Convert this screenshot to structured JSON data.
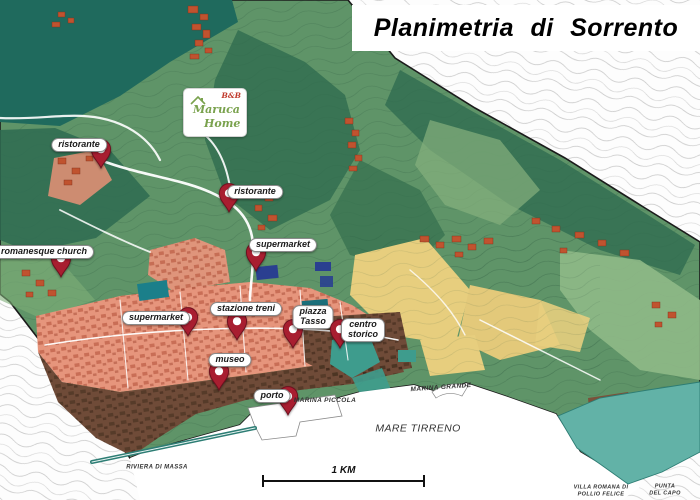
{
  "title": "Planimetria  di  Sorrento",
  "logo": {
    "bnb": "B&B",
    "name_line1": "Maruca",
    "name_line2": "Home"
  },
  "map": {
    "pins": [
      {
        "id": "ristorante-1",
        "label": "ristorante",
        "tip": {
          "x": 101,
          "y": 169
        },
        "label_pos": {
          "x": 79,
          "y": 145
        }
      },
      {
        "id": "ristorante-2",
        "label": "ristorante",
        "tip": {
          "x": 229,
          "y": 213
        },
        "label_pos": {
          "x": 255,
          "y": 192
        }
      },
      {
        "id": "supermarket-1",
        "label": "supermarket",
        "tip": {
          "x": 256,
          "y": 272
        },
        "label_pos": {
          "x": 283,
          "y": 245
        }
      },
      {
        "id": "romanesque-church",
        "label": "romanesque church",
        "tip": {
          "x": 61,
          "y": 278
        },
        "label_pos": {
          "x": 44,
          "y": 252
        }
      },
      {
        "id": "supermarket-2",
        "label": "supermarket",
        "tip": {
          "x": 188,
          "y": 337
        },
        "label_pos": {
          "x": 156,
          "y": 318
        }
      },
      {
        "id": "stazione-treni",
        "label": "stazione treni",
        "tip": {
          "x": 237,
          "y": 341
        },
        "label_pos": {
          "x": 246,
          "y": 309
        }
      },
      {
        "id": "piazza-tasso",
        "label": "piazza\nTasso",
        "tip": {
          "x": 293,
          "y": 349
        },
        "label_pos": {
          "x": 313,
          "y": 317
        }
      },
      {
        "id": "centro-storico",
        "label": "centro\nstorico",
        "tip": {
          "x": 340,
          "y": 349
        },
        "label_pos": {
          "x": 363,
          "y": 330
        }
      },
      {
        "id": "museo",
        "label": "museo",
        "tip": {
          "x": 219,
          "y": 391
        },
        "label_pos": {
          "x": 230,
          "y": 360
        }
      },
      {
        "id": "porto",
        "label": "porto",
        "tip": {
          "x": 288,
          "y": 416
        },
        "label_pos": {
          "x": 272,
          "y": 396
        }
      }
    ],
    "place_labels": [
      {
        "id": "marina-piccola",
        "lines": [
          "MARINA PICCOLA"
        ],
        "x": 325,
        "y": 401,
        "size": 6.5,
        "weight": 700,
        "rotate": 0
      },
      {
        "id": "marina-grande",
        "lines": [
          "MARINA GRANDE"
        ],
        "x": 441,
        "y": 388,
        "size": 6.5,
        "weight": 700,
        "rotate": -4
      },
      {
        "id": "mare-tirreno",
        "lines": [
          "MARE TIRRENO"
        ],
        "x": 418,
        "y": 429,
        "size": 10.5,
        "weight": 400,
        "rotate": 0
      },
      {
        "id": "riviera-di-massa",
        "lines": [
          "RIVIERA DI MASSA"
        ],
        "x": 157,
        "y": 468,
        "size": 6,
        "weight": 700,
        "rotate": 0
      },
      {
        "id": "villa-romana-di-pollio-felice",
        "lines": [
          "VILLA ROMANA DI",
          "POLLIO FELICE"
        ],
        "x": 601,
        "y": 491,
        "size": 5.5,
        "weight": 700,
        "rotate": 0
      },
      {
        "id": "punta-del-capo",
        "lines": [
          "PUNTA",
          "DEL CAPO"
        ],
        "x": 665,
        "y": 490,
        "size": 5.5,
        "weight": 700,
        "rotate": 0
      }
    ],
    "scale": {
      "label": "1 KM"
    }
  },
  "colors": {
    "pin": "#A81E30",
    "pin_stroke": "#6E0F1E",
    "forest_dark_teal": "#1F6A5D",
    "hills_green": "#5F9468",
    "hills_dark_green": "#2F6B4F",
    "light_green": "#8FB987",
    "terrace_yellow": "#E7CE7E",
    "urban_salmon": "#E6957C",
    "historic_brown": "#6F4B38",
    "coast_teal": "#62B2A7",
    "sea_white": "#FFFFFF",
    "hamlet_orange": "#C0532F"
  }
}
